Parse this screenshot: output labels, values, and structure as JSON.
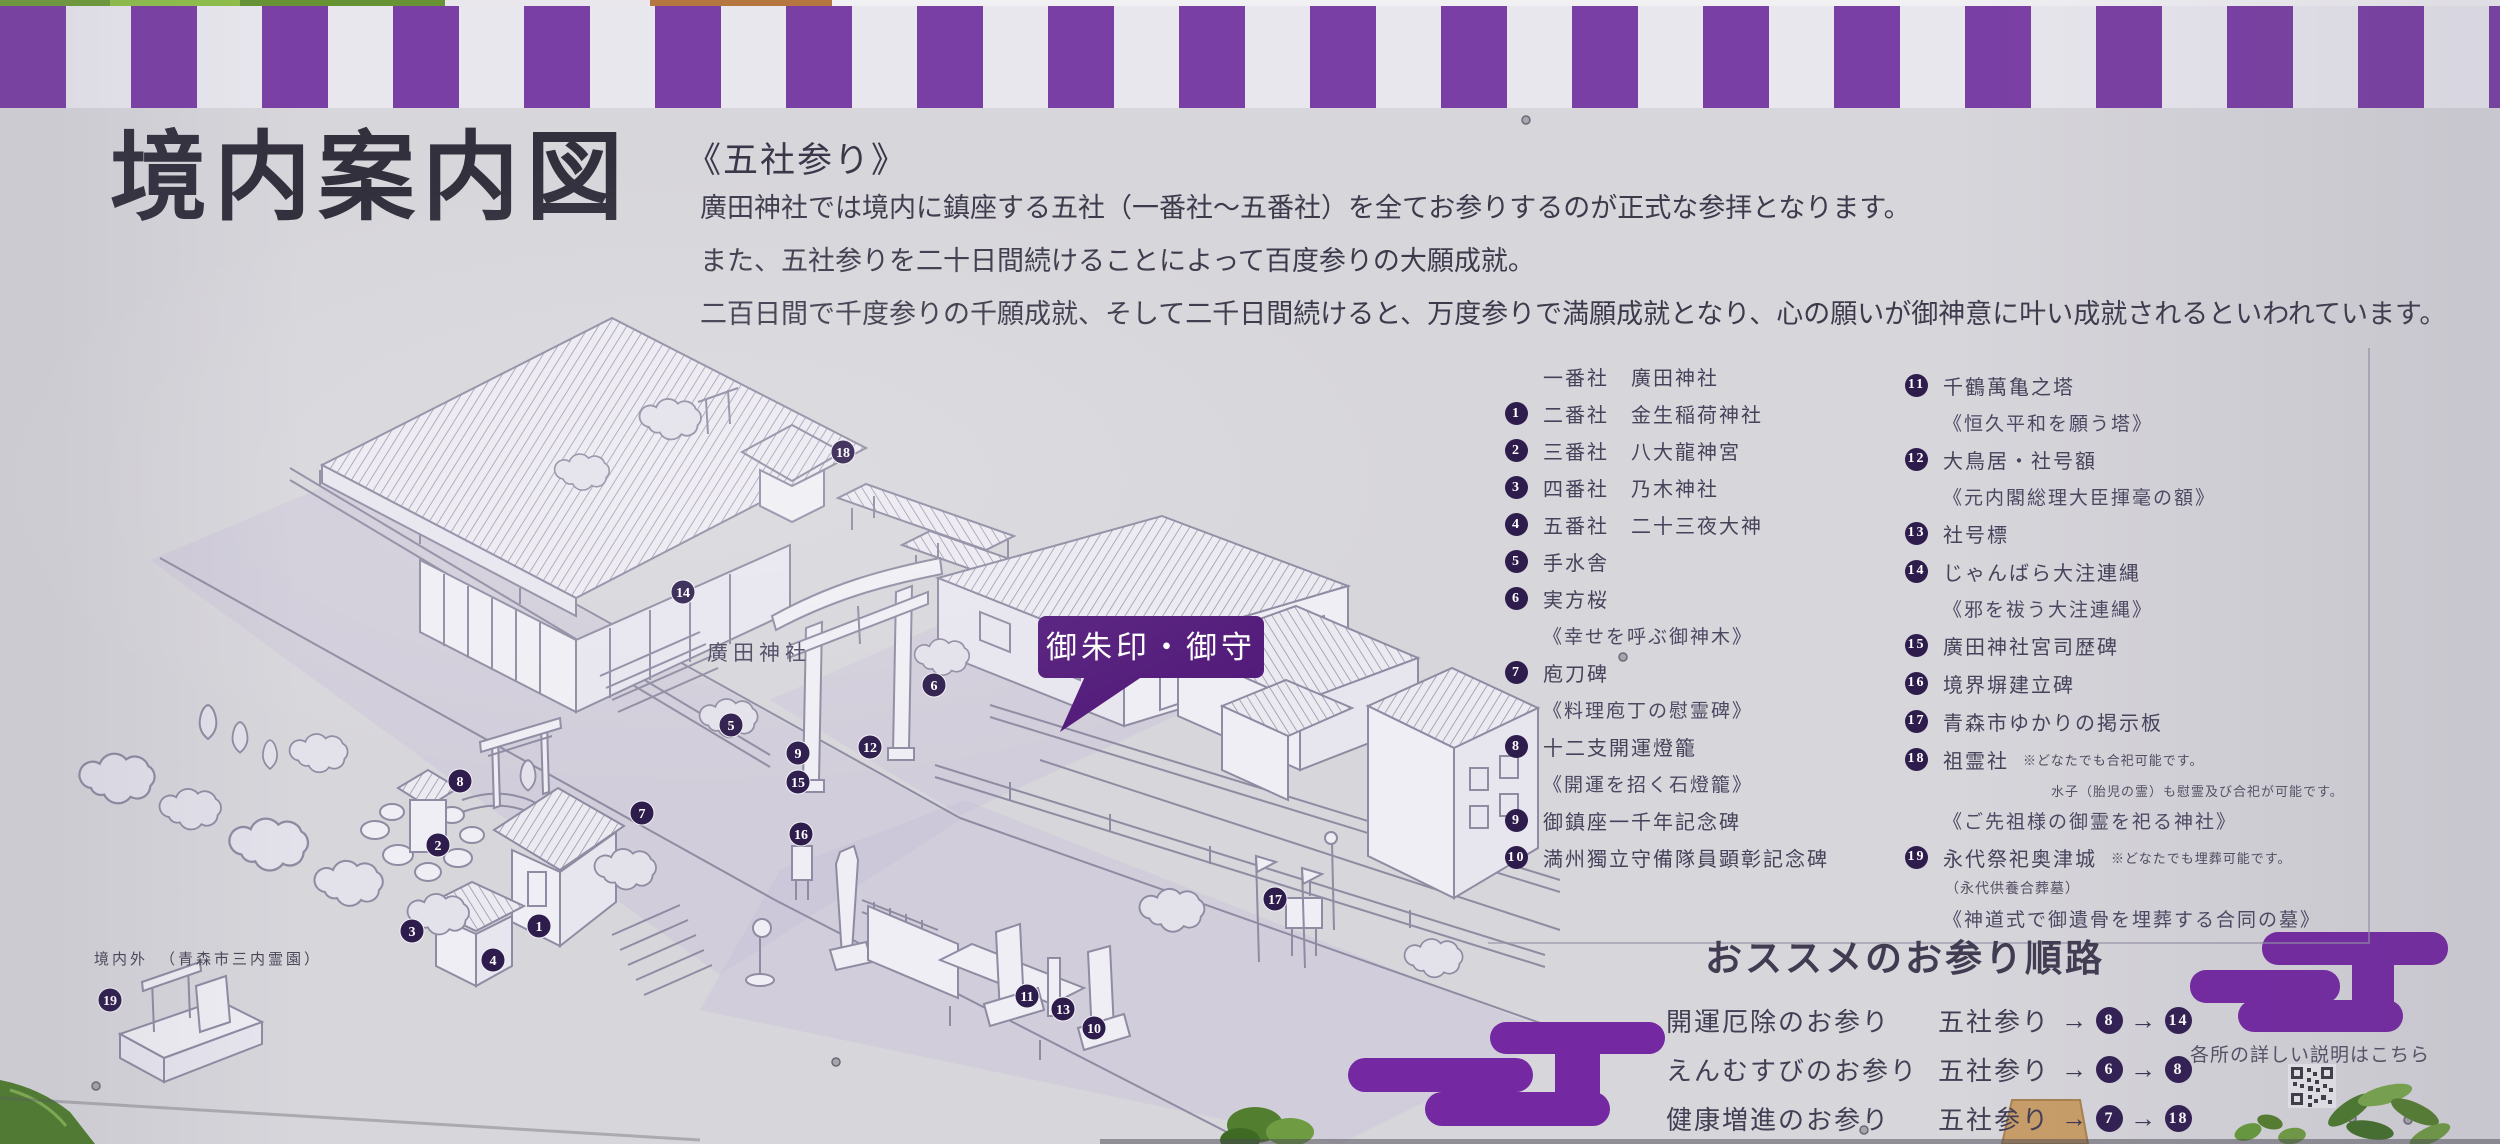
{
  "colors": {
    "stripe_purple": "#7a3fa4",
    "cloud_purple": "#7428a2",
    "badge_purple": "#521a7a",
    "marker_navy": "#2d1c4c"
  },
  "title": "境内案内図",
  "intro": {
    "heading": "《五社参り》",
    "lines": [
      "廣田神社では境内に鎮座する五社（一番社～五番社）を全てお参りするのが正式な参拝となります。",
      "また、五社参りを二十日間続けることによって百度参りの大願成就。",
      "二百日間で千度参りの千願成就、そして二千日間続けると、万度参りで満願成就となり、心の願いが御神意に叶い成就されるといわれています。"
    ]
  },
  "legend": {
    "left": [
      {
        "style": "item",
        "num": null,
        "text": "一番社　廣田神社"
      },
      {
        "style": "item",
        "num": "1",
        "text": "二番社　金生稲荷神社"
      },
      {
        "style": "item",
        "num": "2",
        "text": "三番社　八大龍神宮"
      },
      {
        "style": "item",
        "num": "3",
        "text": "四番社　乃木神社"
      },
      {
        "style": "item",
        "num": "4",
        "text": "五番社　二十三夜大神"
      },
      {
        "style": "item",
        "num": "5",
        "text": "手水舎"
      },
      {
        "style": "item",
        "num": "6",
        "text": "実方桜"
      },
      {
        "style": "note",
        "text": "《幸せを呼ぶ御神木》"
      },
      {
        "style": "item",
        "num": "7",
        "text": "庖刀碑"
      },
      {
        "style": "note",
        "text": "《料理庖丁の慰霊碑》"
      },
      {
        "style": "item",
        "num": "8",
        "text": "十二支開運燈籠"
      },
      {
        "style": "note",
        "text": "《開運を招く石燈籠》"
      },
      {
        "style": "item",
        "num": "9",
        "text": "御鎮座一千年記念碑"
      },
      {
        "style": "item",
        "num": "10",
        "text": "満州獨立守備隊員顕彰記念碑"
      }
    ],
    "right": [
      {
        "style": "item",
        "num": "11",
        "text": "千鶴萬亀之塔"
      },
      {
        "style": "note",
        "text": "《恒久平和を願う塔》"
      },
      {
        "style": "item",
        "num": "12",
        "text": "大鳥居・社号額"
      },
      {
        "style": "note",
        "text": "《元内閣総理大臣揮毫の額》"
      },
      {
        "style": "item",
        "num": "13",
        "text": "社号標"
      },
      {
        "style": "item",
        "num": "14",
        "text": "じゃんばら大注連縄"
      },
      {
        "style": "note",
        "text": "《邪を祓う大注連縄》"
      },
      {
        "style": "item",
        "num": "15",
        "text": "廣田神社宮司歴碑"
      },
      {
        "style": "item",
        "num": "16",
        "text": "境界塀建立碑"
      },
      {
        "style": "item",
        "num": "17",
        "text": "青森市ゆかりの掲示板"
      },
      {
        "style": "item",
        "num": "18",
        "text": "祖霊社",
        "note_inline": "※どなたでも合祀可能です。"
      },
      {
        "style": "sub",
        "text": "水子（胎児の霊）も慰霊及び合祀が可能です。"
      },
      {
        "style": "note",
        "text": "《ご先祖様の御霊を祀る神社》"
      },
      {
        "style": "item",
        "num": "19",
        "text": "永代祭祀奥津城",
        "note_inline": "※どなたでも埋葬可能です。"
      },
      {
        "style": "paren",
        "text": "（永代供養合葬墓）"
      },
      {
        "style": "note",
        "text": "《神道式で御遺骨を埋葬する合同の墓》"
      }
    ]
  },
  "map": {
    "shrine_label": "廣田神社",
    "badge": "御朱印・御守",
    "outside_label": "境内外",
    "outside_paren": "（青森市三内霊園）",
    "markers": [
      {
        "n": "1",
        "x": 539,
        "y": 926
      },
      {
        "n": "2",
        "x": 438,
        "y": 845
      },
      {
        "n": "3",
        "x": 412,
        "y": 931
      },
      {
        "n": "4",
        "x": 493,
        "y": 960
      },
      {
        "n": "5",
        "x": 731,
        "y": 725
      },
      {
        "n": "6",
        "x": 934,
        "y": 685
      },
      {
        "n": "7",
        "x": 642,
        "y": 813
      },
      {
        "n": "8",
        "x": 460,
        "y": 781
      },
      {
        "n": "9",
        "x": 798,
        "y": 753
      },
      {
        "n": "10",
        "x": 1094,
        "y": 1028
      },
      {
        "n": "11",
        "x": 1027,
        "y": 996
      },
      {
        "n": "12",
        "x": 870,
        "y": 747
      },
      {
        "n": "13",
        "x": 1063,
        "y": 1009
      },
      {
        "n": "14",
        "x": 683,
        "y": 592
      },
      {
        "n": "15",
        "x": 798,
        "y": 782
      },
      {
        "n": "16",
        "x": 801,
        "y": 834
      },
      {
        "n": "17",
        "x": 1275,
        "y": 899
      },
      {
        "n": "18",
        "x": 843,
        "y": 452
      },
      {
        "n": "19",
        "x": 110,
        "y": 1000
      }
    ]
  },
  "routes": {
    "heading": "おススメのお参り順路",
    "prefix": "五社参り",
    "rows": [
      {
        "label": "開運厄除のお参り",
        "steps": [
          "8",
          "14"
        ]
      },
      {
        "label": "えんむすびのお参り",
        "steps": [
          "6",
          "8"
        ]
      },
      {
        "label": "健康増進のお参り",
        "steps": [
          "7",
          "18"
        ]
      }
    ]
  },
  "footer": {
    "info": "各所の詳しい説明はこちら"
  }
}
